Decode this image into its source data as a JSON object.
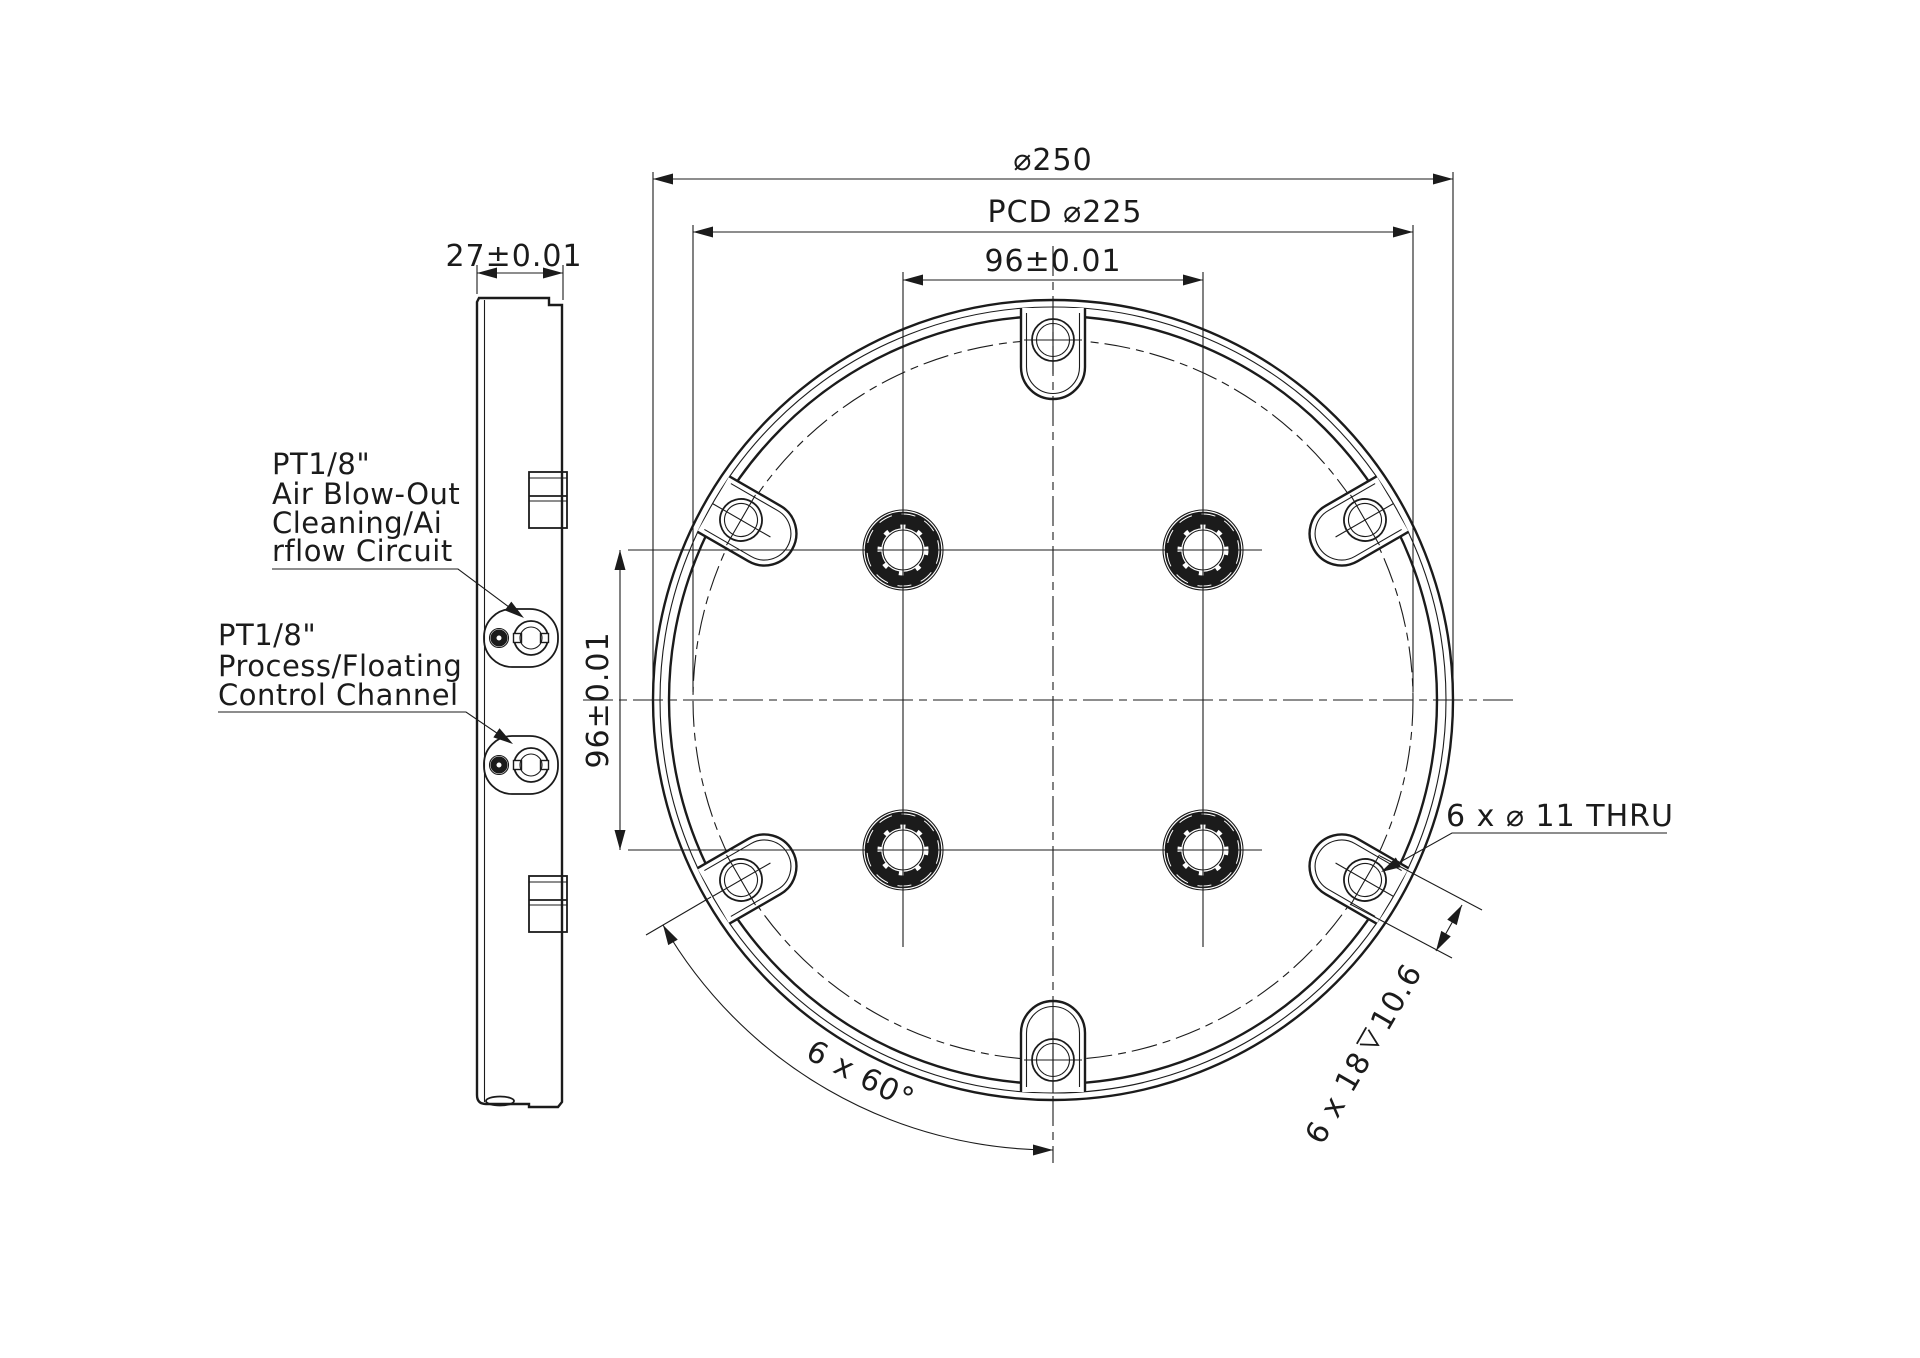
{
  "drawing": {
    "title_block": null,
    "colors": {
      "line": "#1b1b1b",
      "background": "#ffffff"
    },
    "side_view": {
      "thickness_dim": "27±0.01",
      "port1_label": {
        "line1": "PT1/8\"",
        "line2": "Air Blow-Out",
        "line3": "Cleaning/Ai",
        "line4": "rflow Circuit"
      },
      "port2_label": {
        "line1": "PT1/8\"",
        "line2": "Process/Floating",
        "line3": "Control Channel"
      }
    },
    "front_view": {
      "outer_diameter_dim": "⌀250",
      "pcd_dim": "PCD ⌀225",
      "hole_spacing_horizontal_dim": "96±0.01",
      "hole_spacing_vertical_dim": "96±0.01",
      "thru_hole_note": "6 x ⌀ 11 THRU",
      "counterbore_dim_prefix": "6 x 18",
      "counterbore_depth_value": "10.6",
      "bolt_angle_dim": "6 x 60°"
    }
  }
}
